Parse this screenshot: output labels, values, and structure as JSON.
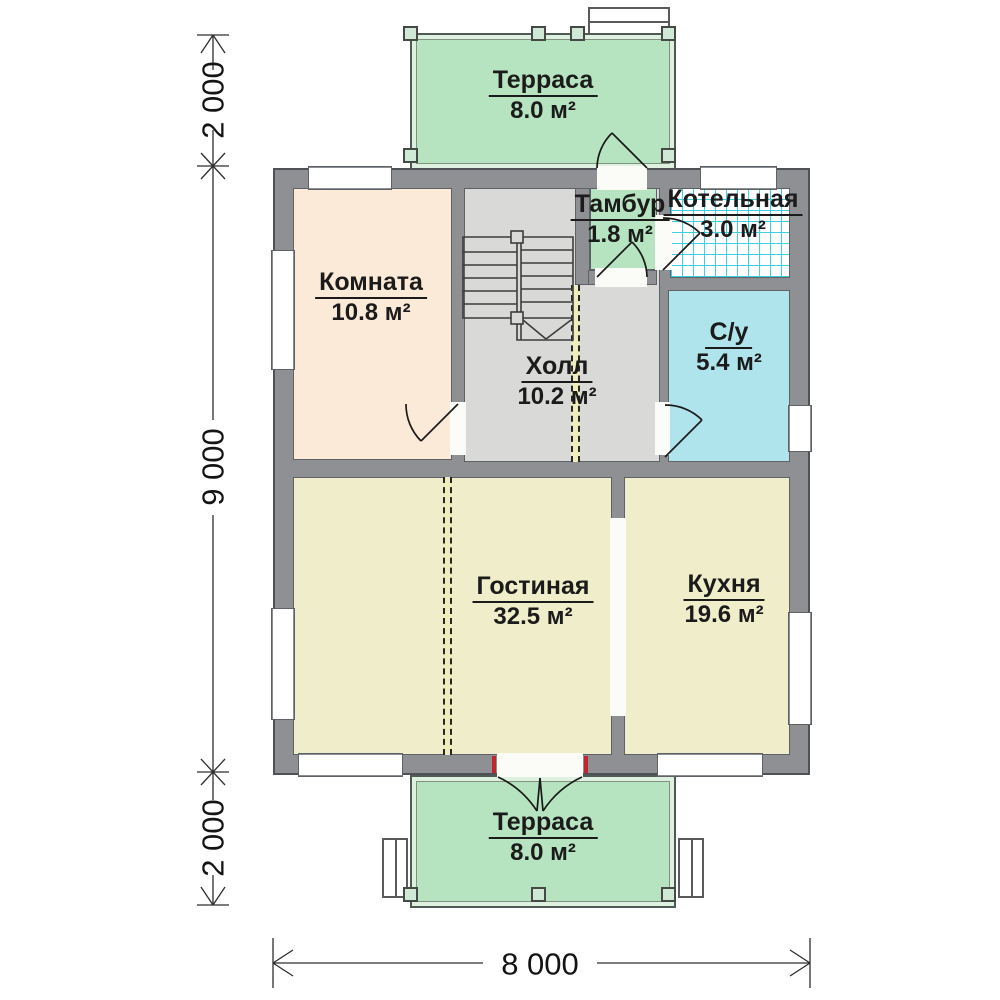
{
  "rooms": {
    "terrace_top": {
      "name": "Терраса",
      "area": "8.0 м²",
      "color": "#b7e4c0"
    },
    "komnata": {
      "name": "Комната",
      "area": "10.8 м²",
      "color": "#fcead8"
    },
    "holl": {
      "name": "Холл",
      "area": "10.2 м²",
      "color": "#d9d9d7"
    },
    "tambur": {
      "name": "Тамбур",
      "area": "1.8 м²",
      "color": "#b7e4c0"
    },
    "kotelnaya": {
      "name": "Котельная",
      "area": "3.0 м²",
      "color": "#ffffff"
    },
    "su": {
      "name": "С/у",
      "area": "5.4 м²",
      "color": "#b0e4ec"
    },
    "gostinaya": {
      "name": "Гостиная",
      "area": "32.5 м²",
      "color": "#efedca"
    },
    "kuhnya": {
      "name": "Кухня",
      "area": "19.6 м²",
      "color": "#efedca"
    },
    "terrace_bottom": {
      "name": "Терраса",
      "area": "8.0 м²",
      "color": "#b7e4c0"
    }
  },
  "dimensions": {
    "left_top": "2 000",
    "left_middle": "9 000",
    "left_bottom": "2 000",
    "bottom_width": "8 000"
  },
  "colors": {
    "wall": "#8e9093",
    "wall_outline": "#4e5156",
    "terrace_fill": "#b7e4c0",
    "tile_grid": "#3fcfe0",
    "door_jamb_red": "#c0272d",
    "dashed_wall_bg": "#efedbe"
  }
}
